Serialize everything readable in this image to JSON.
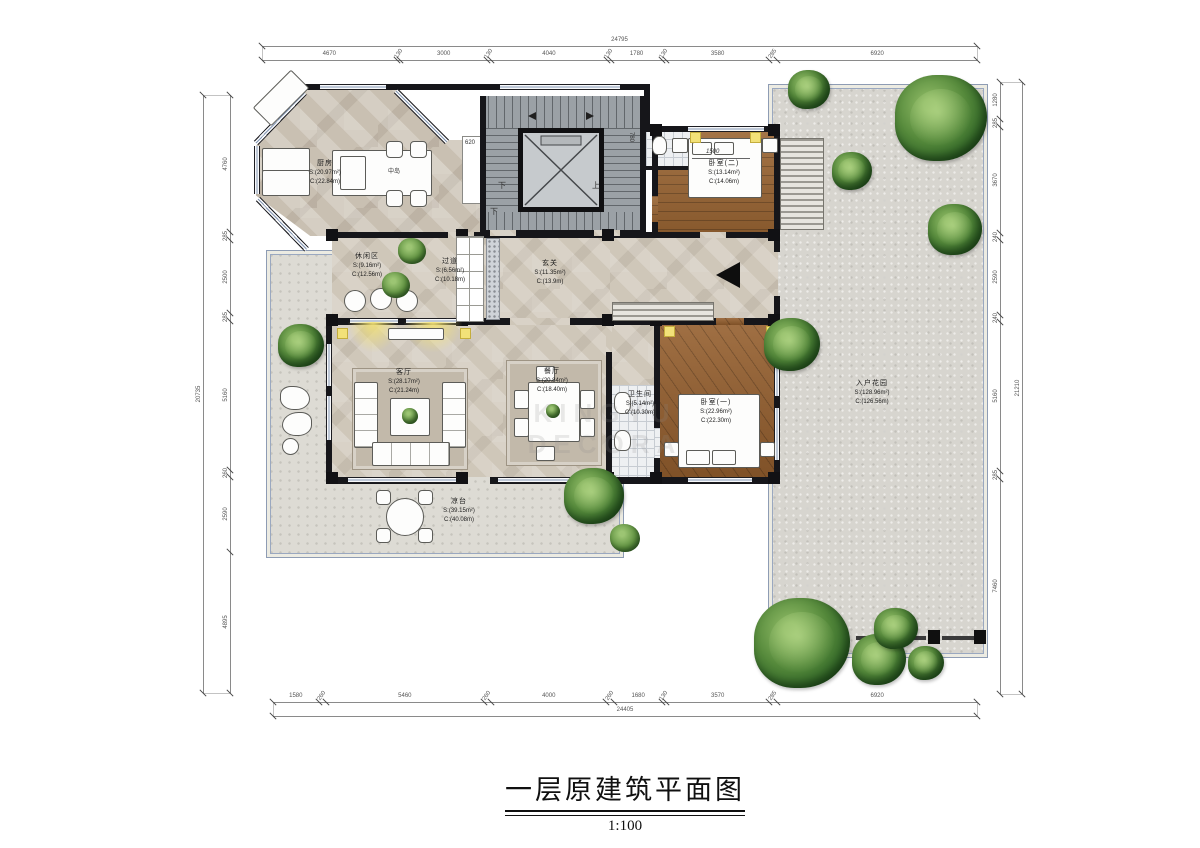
{
  "title": {
    "text": "一层原建筑平面图",
    "scale": "1:100"
  },
  "dims": {
    "top": {
      "total": "24795",
      "segments": [
        "4670",
        "130",
        "3000",
        "130",
        "4040",
        "130",
        "1780",
        "130",
        "3580",
        "285",
        "6920"
      ]
    },
    "bottom": {
      "total": "24405",
      "segments": [
        "1580",
        "260",
        "5460",
        "260",
        "4000",
        "260",
        "1680",
        "130",
        "3570",
        "285",
        "6920"
      ]
    },
    "left": {
      "total": "20735",
      "segments": [
        "4760",
        "285",
        "2500",
        "285",
        "5160",
        "260",
        "2590",
        "4895"
      ]
    },
    "right": {
      "total": "21210",
      "segments": [
        "1280",
        "285",
        "3670",
        "240",
        "2590",
        "240",
        "5160",
        "285",
        "7460"
      ]
    }
  },
  "rooms": [
    {
      "id": "kitchen",
      "name": "厨房",
      "s": "S:(20.97m²)",
      "c": "C:(22.84m)",
      "x": 325,
      "y": 173
    },
    {
      "id": "lounge",
      "name": "休闲区",
      "s": "S:(9.16m²)",
      "c": "C:(12.56m)",
      "x": 367,
      "y": 266
    },
    {
      "id": "corridor",
      "name": "过道",
      "s": "S:(6.56m²)",
      "c": "C:(10.18m)",
      "x": 450,
      "y": 271
    },
    {
      "id": "foyer",
      "name": "玄关",
      "s": "S:(11.35m²)",
      "c": "C:(13.9m)",
      "x": 550,
      "y": 273
    },
    {
      "id": "living",
      "name": "客厅",
      "s": "S:(28.17m²)",
      "c": "C:(21.24m)",
      "x": 404,
      "y": 382
    },
    {
      "id": "dining",
      "name": "餐厅",
      "s": "S:(20.84m²)",
      "c": "C:(18.40m)",
      "x": 552,
      "y": 381
    },
    {
      "id": "bath",
      "name": "卫生间",
      "s": "S:(5.14m²)",
      "c": "C:(10.30m)",
      "x": 640,
      "y": 404
    },
    {
      "id": "bedroom-1",
      "name": "卧室(一)",
      "s": "S:(22.96m²)",
      "c": "C:(22.30m)",
      "x": 716,
      "y": 412
    },
    {
      "id": "bedroom-2",
      "name": "卧室(二)",
      "s": "S:(13.14m²)",
      "c": "C:(14.06m)",
      "x": 724,
      "y": 173
    },
    {
      "id": "veranda",
      "name": "凉台",
      "s": "S:(39.15m²)",
      "c": "C:(40.08m)",
      "x": 459,
      "y": 511
    },
    {
      "id": "entry-garden",
      "name": "入户花园",
      "s": "S:(128.96m²)",
      "c": "C:(126.56m)",
      "x": 872,
      "y": 393
    }
  ],
  "annotations": {
    "island": "中岛",
    "bed_width": "1500",
    "stair_width": "620",
    "stair_depth": "780",
    "stairs_down": "下",
    "stairs_down2": "下",
    "stairs_up": "上"
  },
  "watermark": "KINGYU DECORA",
  "colors": {
    "wall": "#16161a",
    "window_blue": "#8497b4",
    "wood": "#955f2e",
    "marble": "#c9c0b2",
    "tree_green": "#2e6426",
    "accent_yellow": "#f2e178"
  }
}
